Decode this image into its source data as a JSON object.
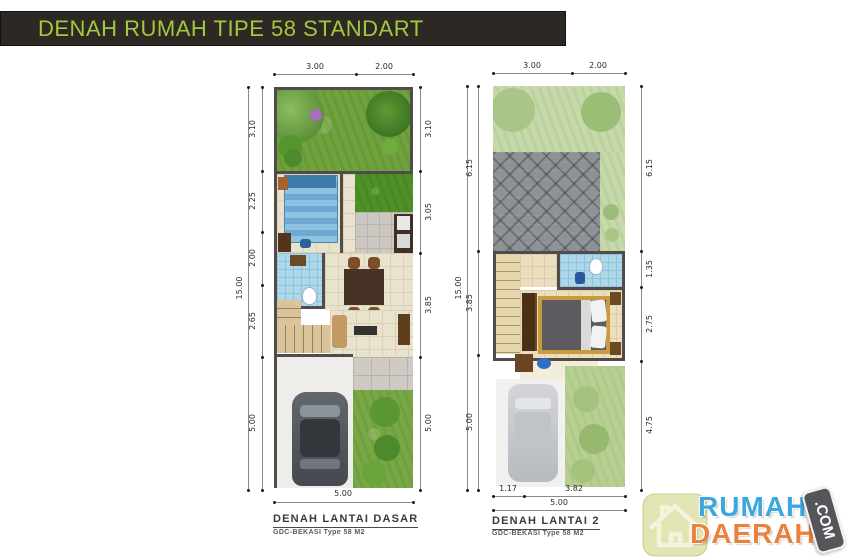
{
  "title_bar": {
    "text": "DENAH RUMAH TIPE 58 STANDART",
    "bg_color": "#2e2824",
    "text_color": "#a3c83e"
  },
  "plans": [
    {
      "name": "ground-floor",
      "caption": "DENAH LANTAI DASAR",
      "subcaption": "GDC-BEKASI Type 58 M2",
      "dims": {
        "top": [
          "3.00",
          "2.00"
        ],
        "left_outer": [
          "15.00"
        ],
        "left_inner": [
          "3.10",
          "2.25",
          "2.00",
          "2.65",
          "5.00"
        ],
        "right": [
          "3.10",
          "3.05",
          "3.85",
          "5.00"
        ],
        "bottom": [
          "5.00"
        ]
      },
      "rooms": [
        "garden",
        "bedroom",
        "inner-garden",
        "kitchen",
        "bathroom",
        "dining",
        "stairs",
        "living",
        "terrace",
        "carport",
        "side-garden"
      ]
    },
    {
      "name": "second-floor",
      "caption": "DENAH LANTAI 2",
      "subcaption": "GDC-BEKASI Type 58 M2",
      "dims": {
        "top": [
          "3.00",
          "2.00"
        ],
        "left_outer": [
          "15.00"
        ],
        "left_inner": [
          "6.15",
          "3.85",
          "5.00"
        ],
        "right": [
          "6.15",
          "1.35",
          "2.75",
          "4.75"
        ],
        "bottom_inner": [
          "1.17",
          "3.82"
        ],
        "bottom": [
          "5.00"
        ]
      },
      "rooms": [
        "garden-below",
        "roof",
        "stairs",
        "bathroom",
        "bedroom",
        "carport-below",
        "side-garden-below"
      ]
    }
  ],
  "logo": {
    "line1": "RUMAH",
    "line2": "DAERAH",
    "badge": ".COM",
    "icon": "house-icon",
    "colors": {
      "line1": "#3ba7de",
      "line2": "#e8823c",
      "badge_bg": "#55565a",
      "icon_bg": "#e2e4b3"
    }
  }
}
